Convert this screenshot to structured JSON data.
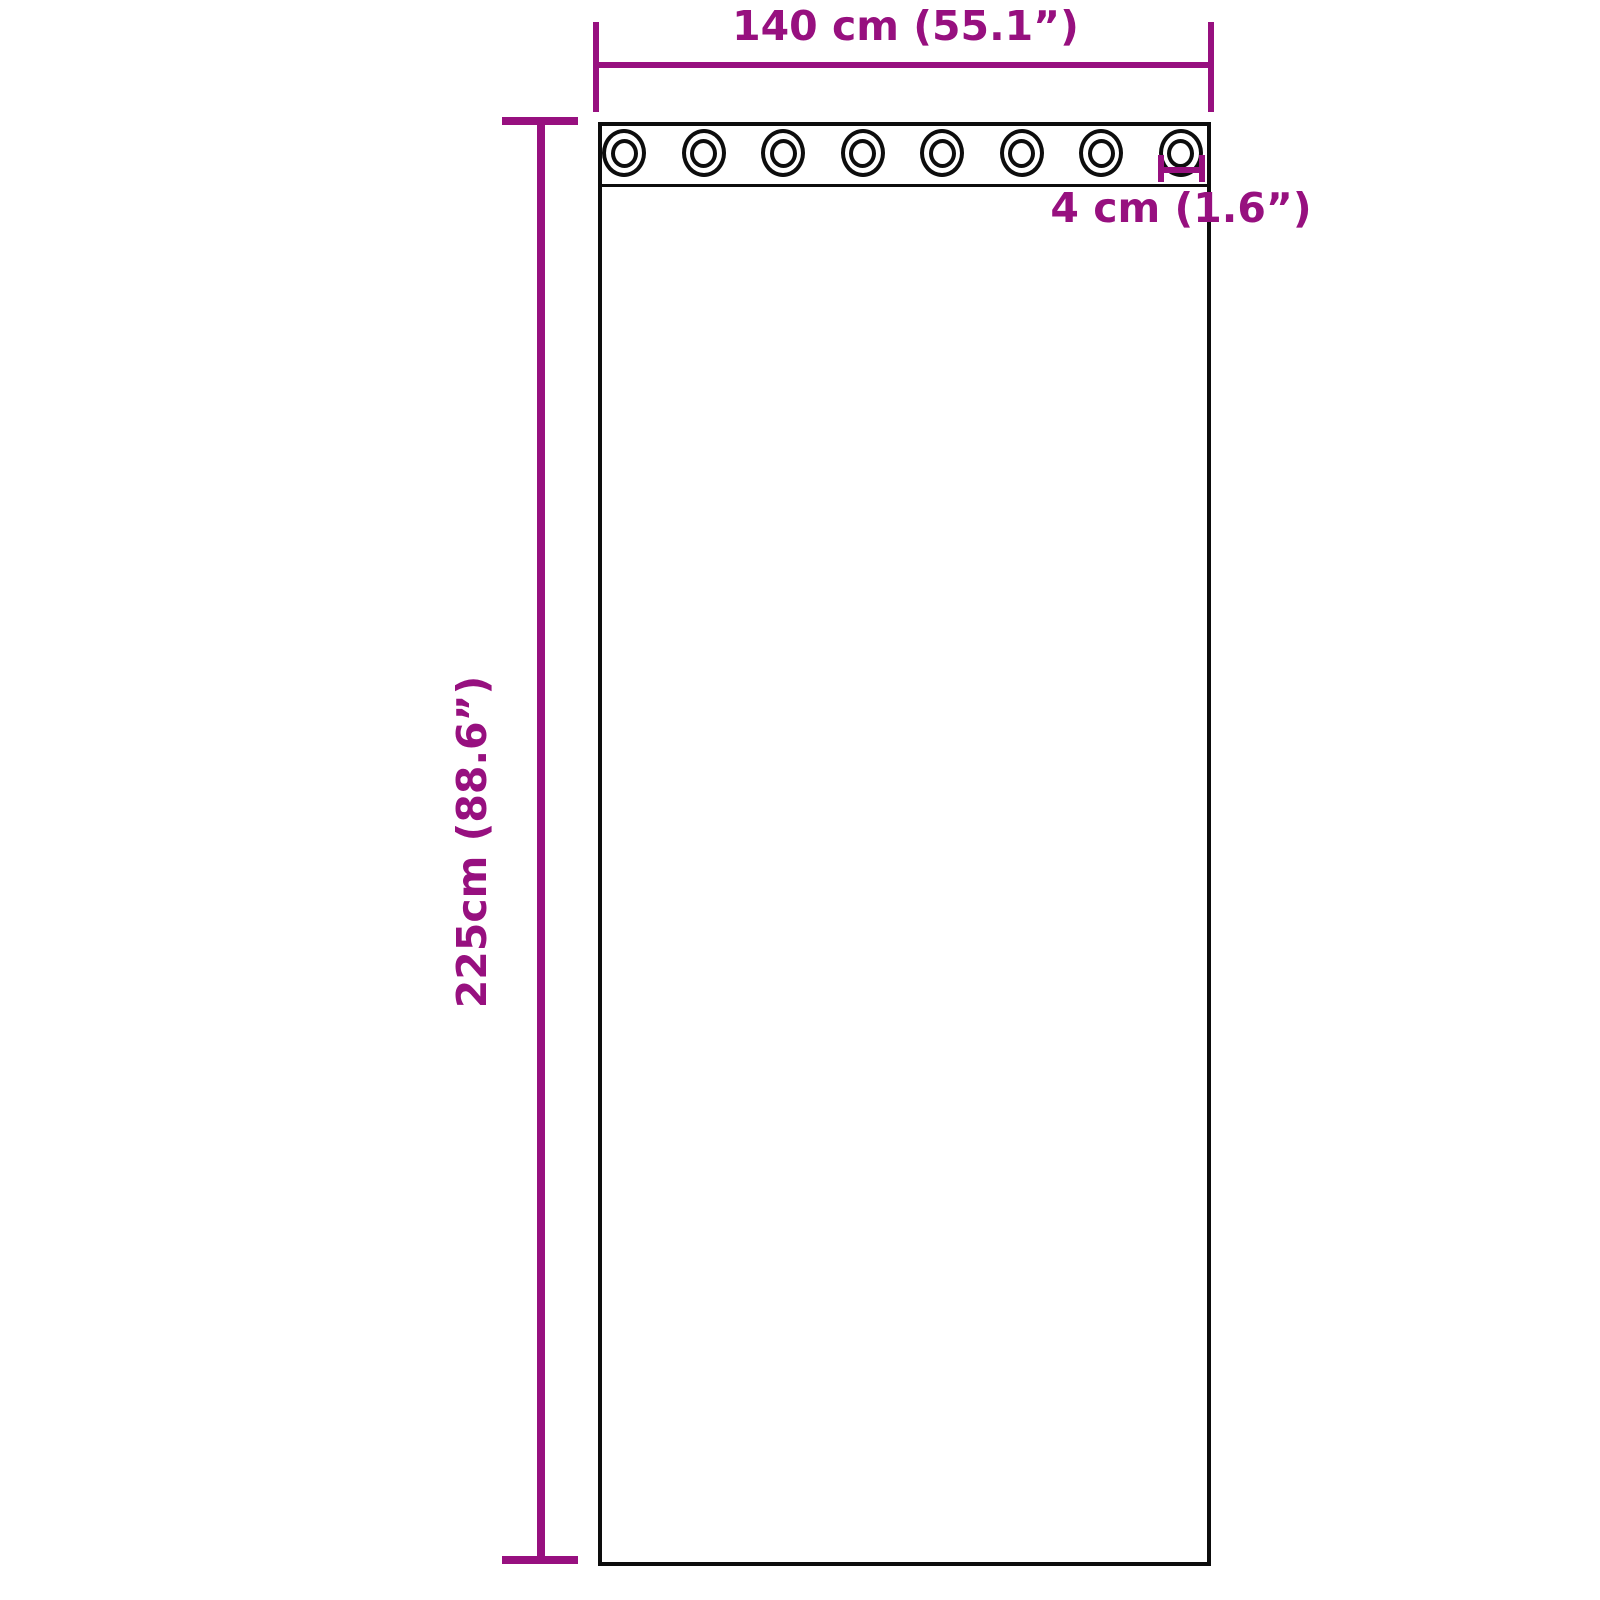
{
  "diagram": {
    "type": "product-dimension-diagram",
    "subject": "curtain panel with grommets",
    "colors": {
      "accent": "#97107F",
      "outline": "#0d0d0d",
      "background": "#ffffff"
    },
    "dimensions": {
      "width_label": "140 cm (55.1”)",
      "height_label": "225cm (88.6”)",
      "grommet_label": "4 cm (1.6”)"
    },
    "grommets": {
      "count": 8,
      "icon": "grommet-icon",
      "shape": "double-ring-circle"
    }
  }
}
